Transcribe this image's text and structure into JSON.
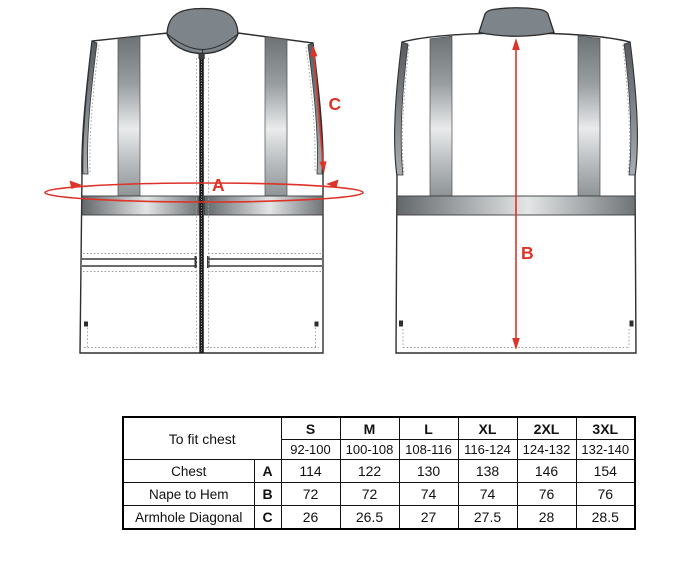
{
  "diagram": {
    "annotation_color": "#dd3328",
    "collar_color": "#7d858b",
    "front_view": {
      "measure_a": "A",
      "measure_c": "C"
    },
    "back_view": {
      "measure_b": "B"
    }
  },
  "size_table": {
    "fit_label": "To fit chest",
    "sizes": [
      "S",
      "M",
      "L",
      "XL",
      "2XL",
      "3XL"
    ],
    "fit_ranges": [
      "92-100",
      "100-108",
      "108-116",
      "116-124",
      "124-132",
      "132-140"
    ],
    "rows": [
      {
        "label": "Chest",
        "letter": "A",
        "values": [
          "114",
          "122",
          "130",
          "138",
          "146",
          "154"
        ]
      },
      {
        "label": "Nape to Hem",
        "letter": "B",
        "values": [
          "72",
          "72",
          "74",
          "74",
          "76",
          "76"
        ]
      },
      {
        "label": "Armhole Diagonal",
        "letter": "C",
        "values": [
          "26",
          "26.5",
          "27",
          "27.5",
          "28",
          "28.5"
        ]
      }
    ]
  }
}
